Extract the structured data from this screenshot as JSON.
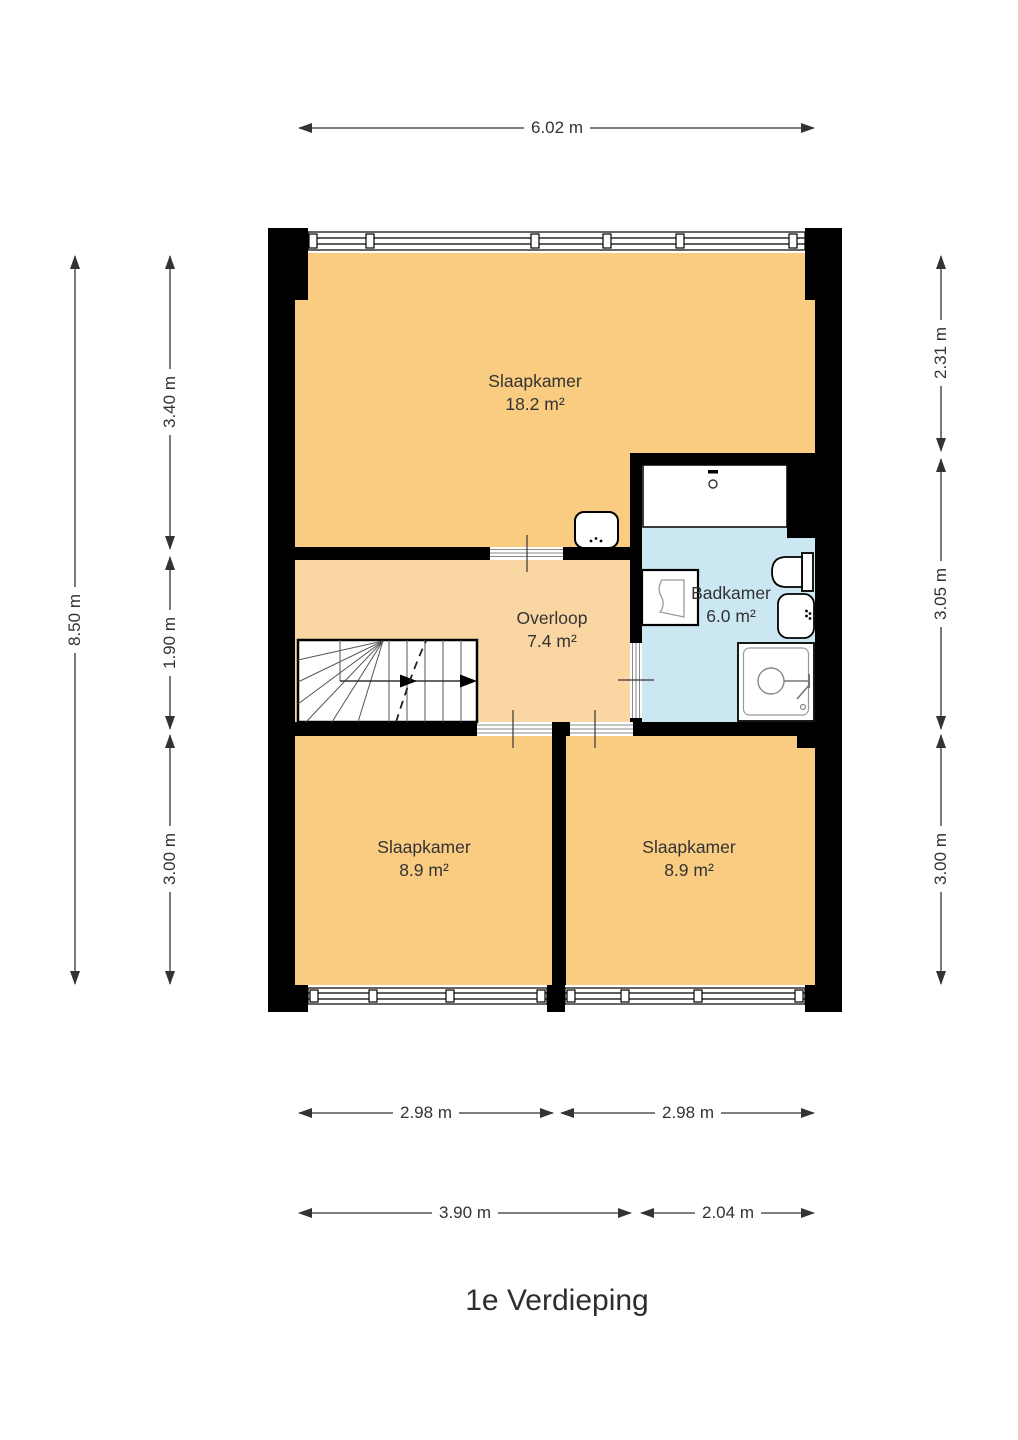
{
  "title": "1e Verdieping",
  "rooms": {
    "slaapkamer_main": {
      "name": "Slaapkamer",
      "area": "18.2 m²"
    },
    "overloop": {
      "name": "Overloop",
      "area": "7.4 m²"
    },
    "badkamer": {
      "name": "Badkamer",
      "area": "6.0 m²"
    },
    "slaapkamer_left": {
      "name": "Slaapkamer",
      "area": "8.9 m²"
    },
    "slaapkamer_right": {
      "name": "Slaapkamer",
      "area": "8.9 m²"
    }
  },
  "dimensions": {
    "top_width": "6.02 m",
    "left_outer_height": "8.50 m",
    "left_inner": [
      "3.40 m",
      "1.90 m",
      "3.00 m"
    ],
    "right": [
      "2.31 m",
      "3.05 m",
      "3.00 m"
    ],
    "bottom_room_widths": [
      "2.98 m",
      "2.98 m"
    ],
    "bottom_section_widths": [
      "3.90 m",
      "2.04 m"
    ]
  },
  "fixtures": [
    "staircase",
    "washbasin",
    "bathtub",
    "washing-machine",
    "toilet",
    "sink",
    "shower"
  ],
  "colors": {
    "bedroom_fill": "#FACC82",
    "hall_fill": "#FAD7A2",
    "bathroom_fill": "#CBE8F2",
    "wall": "#000000",
    "dimension_text": "#333333"
  }
}
